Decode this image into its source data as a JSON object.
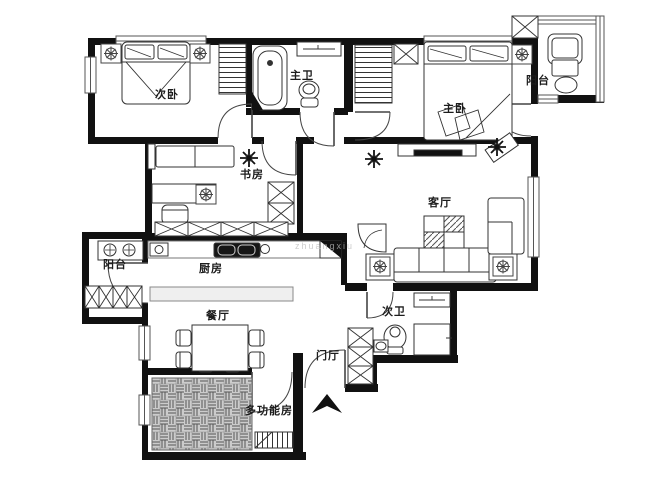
{
  "rooms": [
    {
      "id": "secondary-bedroom",
      "label": "次卧"
    },
    {
      "id": "master-bathroom",
      "label": "主卫"
    },
    {
      "id": "master-bedroom",
      "label": "主卧"
    },
    {
      "id": "balcony-top-right",
      "label": "阳台"
    },
    {
      "id": "study",
      "label": "书房"
    },
    {
      "id": "living-room",
      "label": "客厅"
    },
    {
      "id": "balcony-left",
      "label": "阳台"
    },
    {
      "id": "kitchen",
      "label": "厨房"
    },
    {
      "id": "dining-room",
      "label": "餐厅"
    },
    {
      "id": "secondary-bathroom",
      "label": "次卫"
    },
    {
      "id": "entry-hall",
      "label": "门厅"
    },
    {
      "id": "multi-function-room",
      "label": "多功能房"
    }
  ],
  "watermark": {
    "text": "zhuangxiu"
  },
  "furniture": [
    "double-bed",
    "nightstand-lamp",
    "wardrobe",
    "bathtub",
    "toilet",
    "vanity-counter",
    "lounge-chair",
    "side-table",
    "round-stool",
    "bookshelf",
    "desk",
    "desk-chair",
    "bench-sofa",
    "tv-cabinet",
    "tv",
    "coffee-table",
    "sofa",
    "armchair",
    "fan-chair",
    "plant",
    "gas-stove",
    "kitchen-sink",
    "corner-cabinet",
    "kitchen-island",
    "dining-table",
    "dining-chair",
    "tatami-floor",
    "shoe-cabinet",
    "shower",
    "washbasin",
    "storage-cabinet"
  ],
  "colors": {
    "wall": "#111111",
    "line": "#444444",
    "floor_gray": "#c9c9c9"
  }
}
